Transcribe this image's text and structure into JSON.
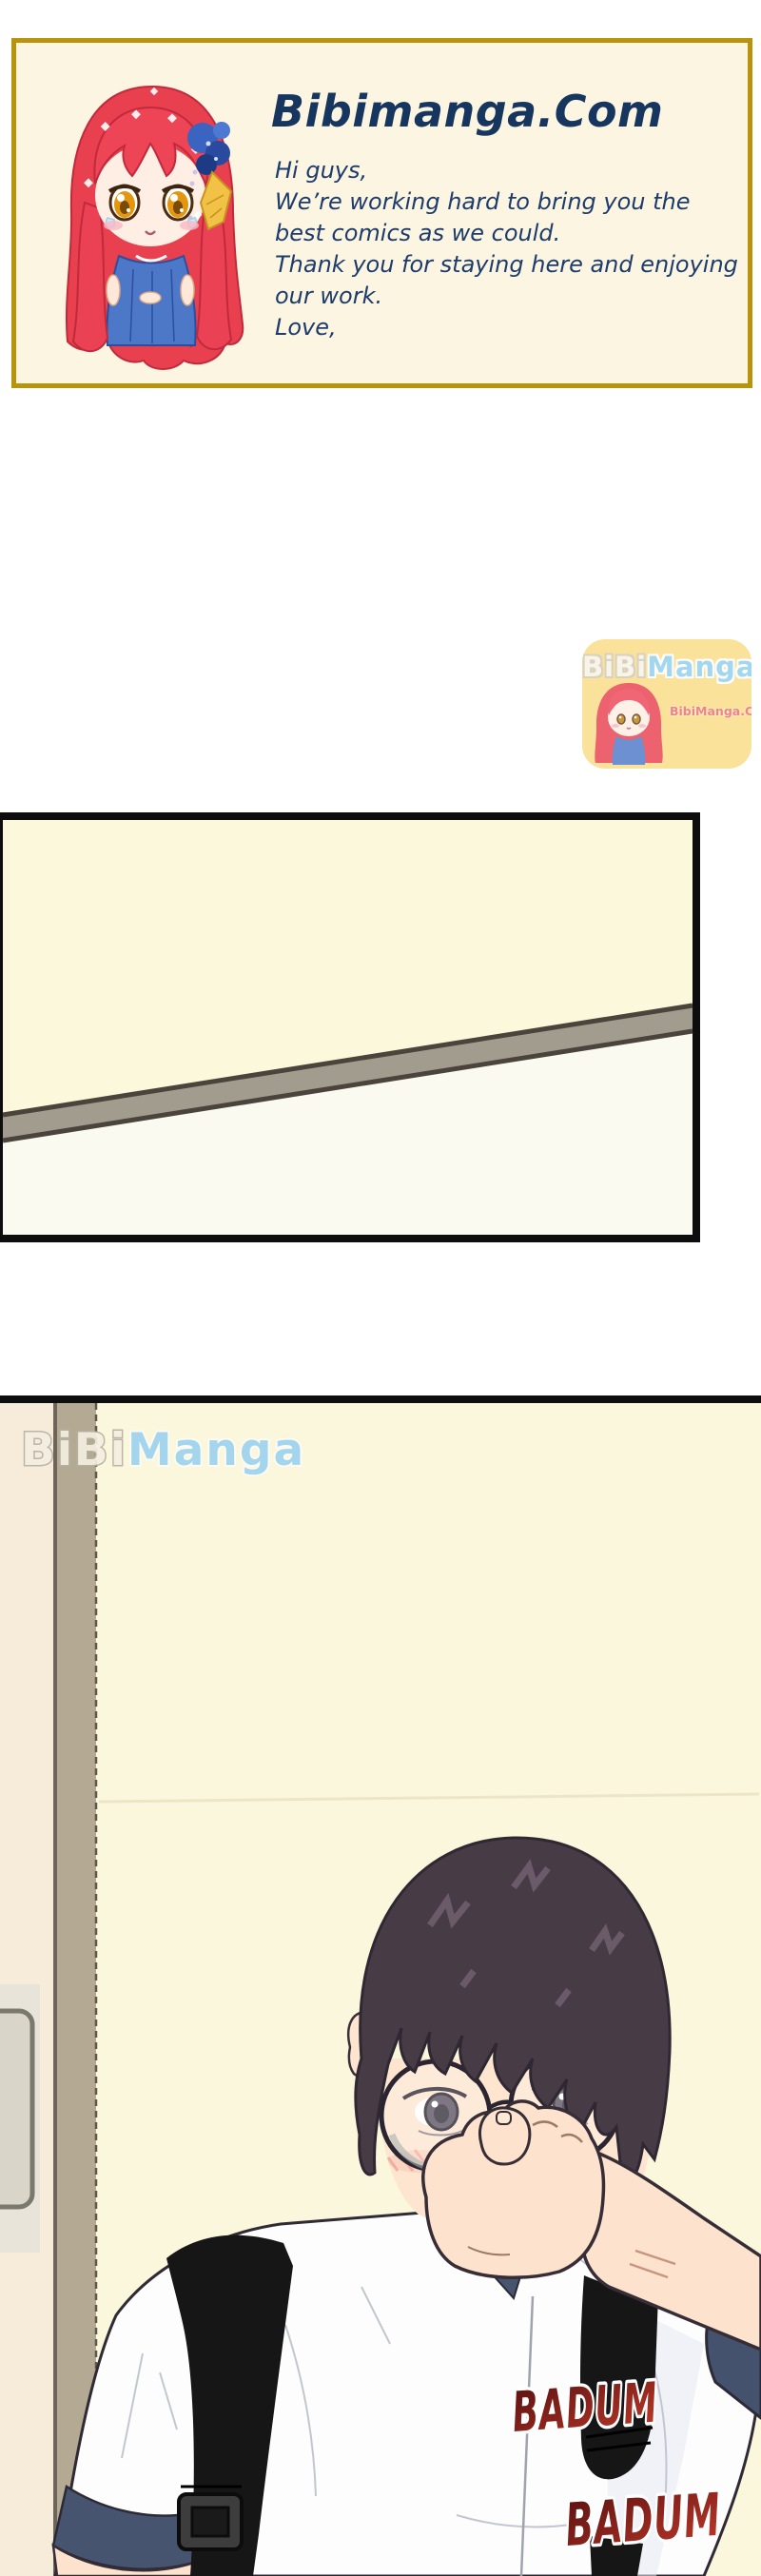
{
  "header": {
    "title": "Bibimanga.Com",
    "message_lines": [
      "Hi guys,",
      "We’re working hard to bring you the",
      "best comics as we could.",
      "Thank you for staying here and enjoying",
      "our work.",
      "Love,"
    ]
  },
  "sticker": {
    "brand_part1": "BiBi",
    "brand_part2": "Manga",
    "url": "BibiManga.Com"
  },
  "watermark": {
    "part1": "BiBi",
    "part2": "Manga"
  },
  "sfx": {
    "badum1": "BADUM",
    "badum2": "BADUM"
  },
  "colors": {
    "header_border": "#b8940c",
    "header_bg": "#fbf5e1",
    "title_navy": "#16355f",
    "message_navy": "#1e3c6b",
    "sticker_yellow": "#fbdc84",
    "sticker_blue": "#8fcfec",
    "sticker_url_pink": "#e96a74",
    "panel_yellow": "#fcf8db",
    "panel_bar_gray": "#a29c8f",
    "wall_yellow": "#fbf7dc",
    "wall_cream": "#f6ecd9",
    "frame_tan": "#b4a993",
    "hair_dark": "#473c46",
    "skin": "#fde3cd",
    "collar_navy": "#46546f",
    "strap_black": "#161616",
    "badum_red_dark": "#571010",
    "badum_red_light": "#c23a2a",
    "watermark_blue": "#9dd3ee"
  }
}
